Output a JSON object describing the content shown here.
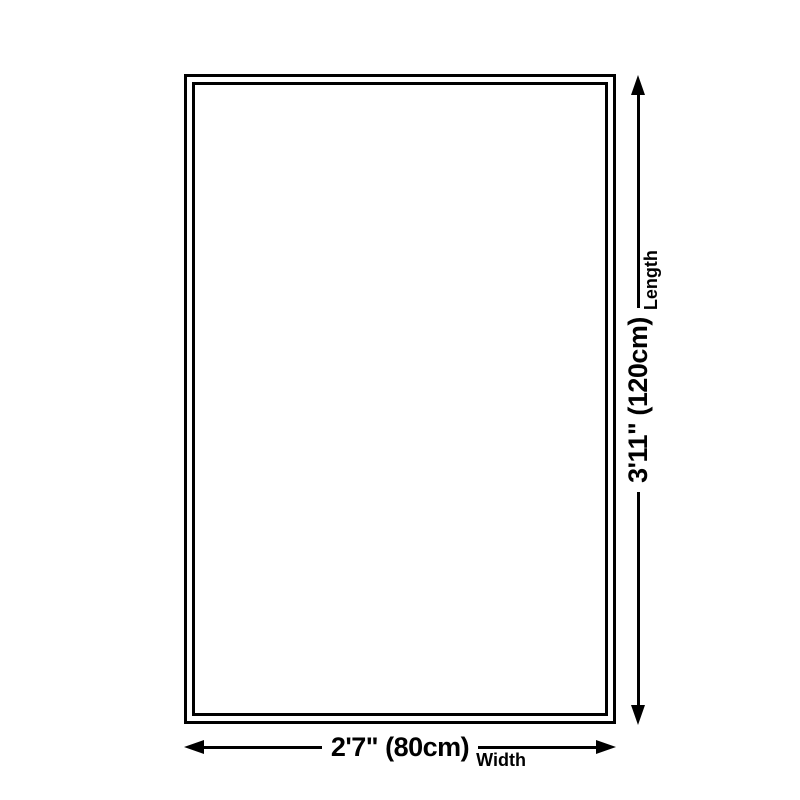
{
  "diagram": {
    "type": "product-size-diagram",
    "shape": "rectangle",
    "colors": {
      "background": "#ffffff",
      "line": "#000000",
      "text": "#000000"
    }
  },
  "dimensions": {
    "length": {
      "value": "3'11\" (120cm)",
      "label": "Length"
    },
    "width": {
      "value": "2'7\" (80cm)",
      "label": "Width"
    }
  }
}
